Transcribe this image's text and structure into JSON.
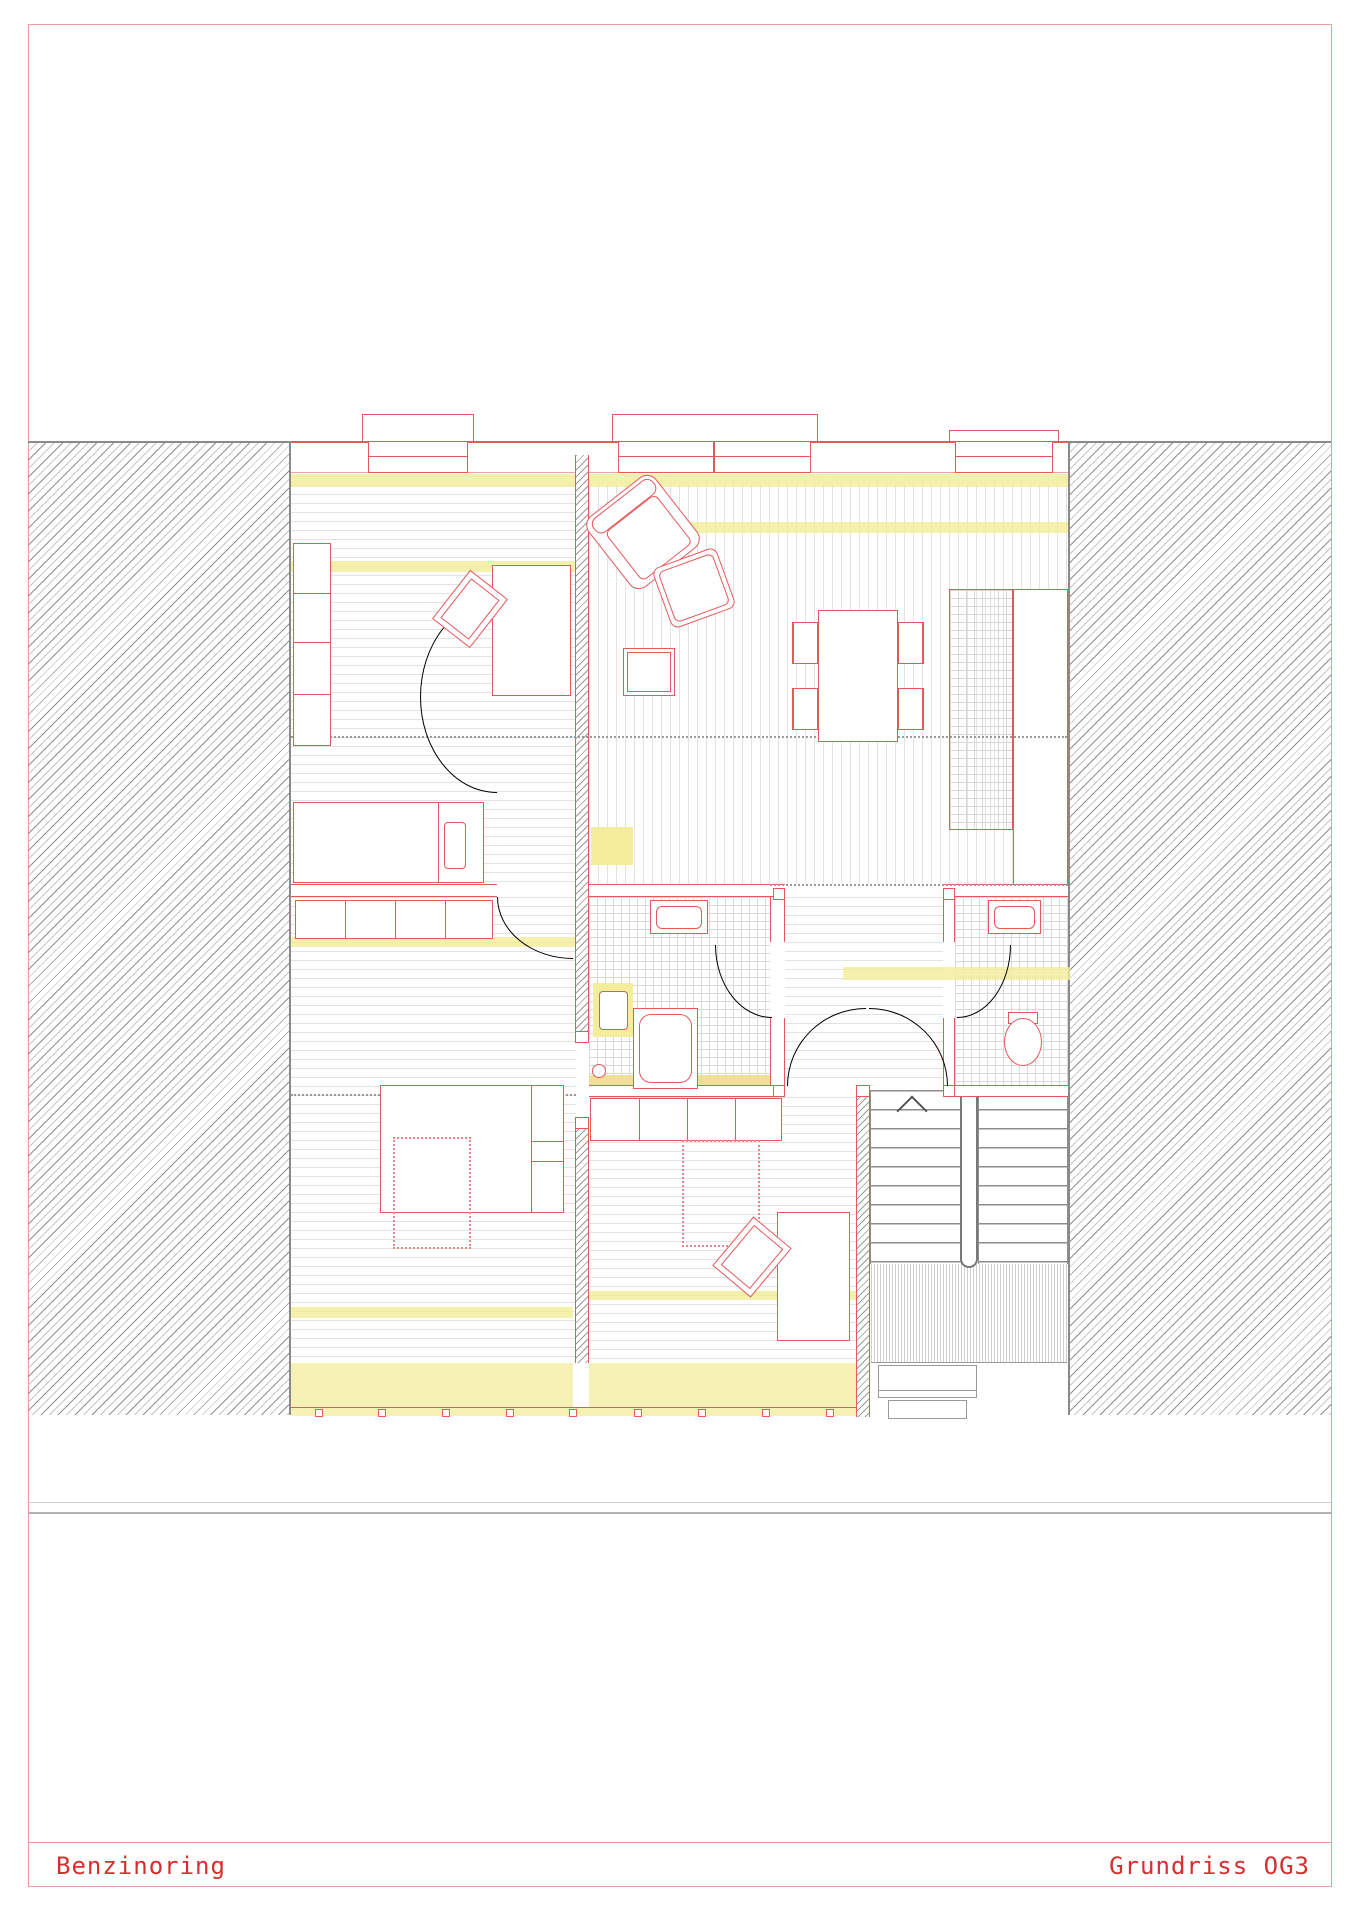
{
  "title_block": {
    "project_name": "Benzinoring",
    "drawing_name": "Grundriss OG3"
  },
  "colors": {
    "line_red": "#e4595c",
    "frame_red": "#e89b9b",
    "title_text_red": "#d62f2f",
    "highlight_yellow": "#f4ed9b",
    "highlight_orange": "#f2dd8d",
    "hatch_gray": "#8f8f8f",
    "floor_line_gray": "#e3e3e3"
  }
}
